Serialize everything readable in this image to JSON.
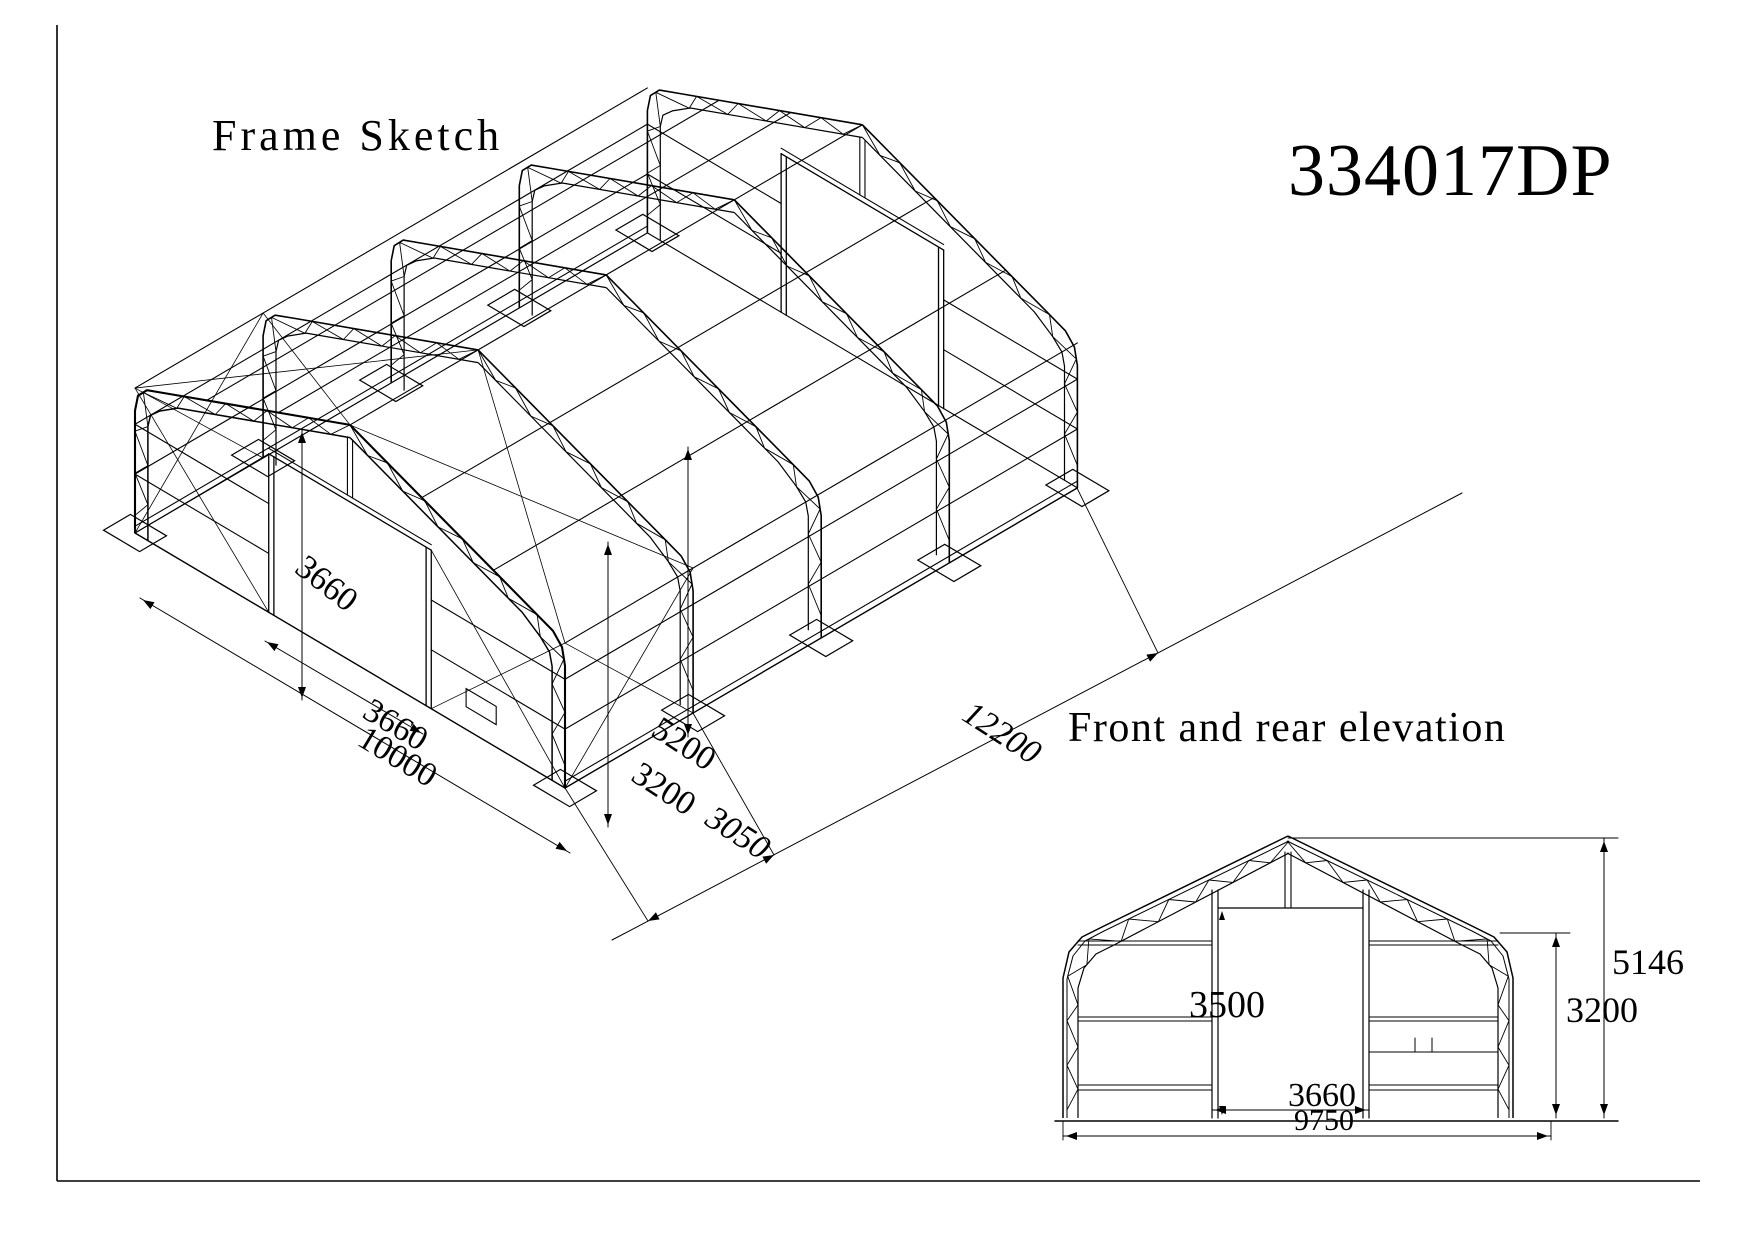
{
  "sheet": {
    "title": "Frame Sketch",
    "model_number": "334017DP",
    "elevation_caption": "Front and rear elevation"
  },
  "isometric": {
    "dim_side_height": "3660",
    "dim_door_width": "3660",
    "dim_front_width": "10000",
    "dim_ridge_height": "5200",
    "dim_eave_height": "3200",
    "dim_bay_spacing": "3050",
    "dim_length": "12200"
  },
  "elevation": {
    "dim_door_height": "3500",
    "dim_door_width": "3660",
    "dim_base_width": "9750",
    "dim_total_height": "5146",
    "dim_eave_height": "3200"
  },
  "colors": {
    "line": "#000000",
    "paper": "#ffffff"
  }
}
